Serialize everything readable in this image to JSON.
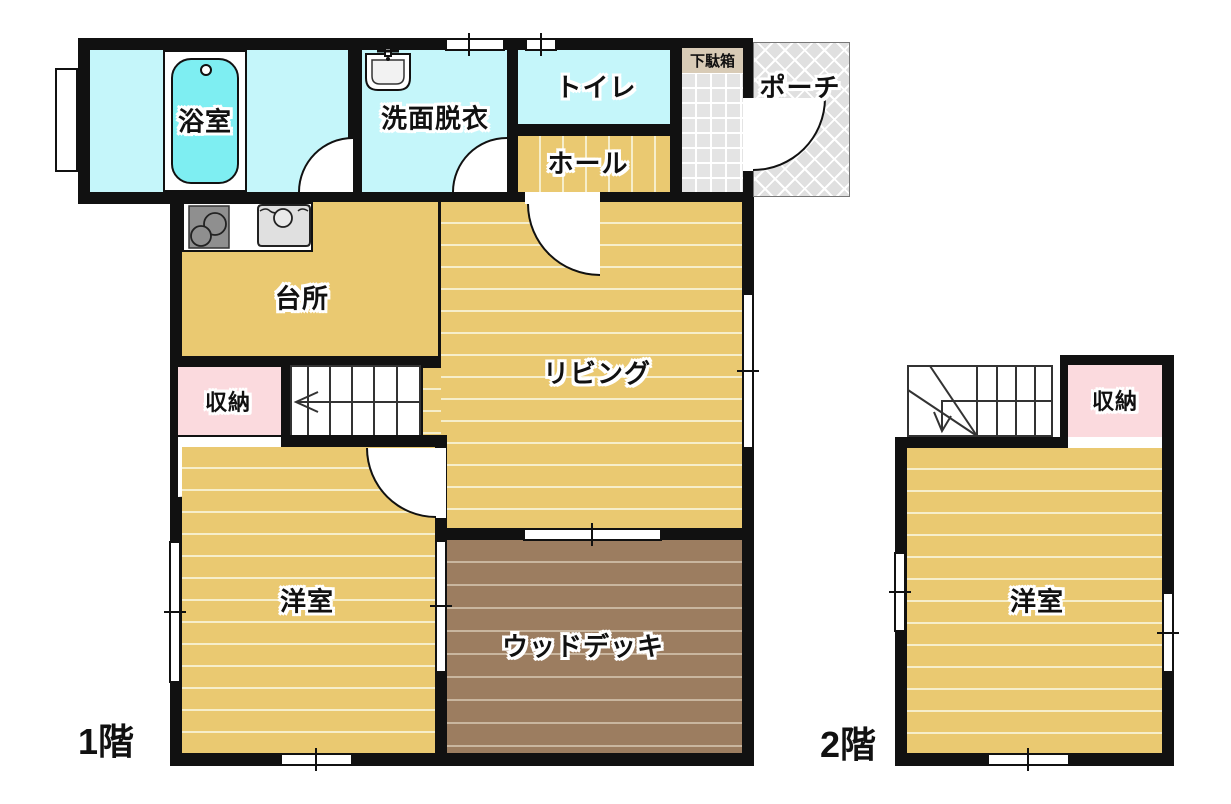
{
  "plan": {
    "floor1": {
      "label": "1階",
      "rooms": {
        "bath": "浴室",
        "washroom": "洗面脱衣",
        "toilet": "トイレ",
        "hall": "ホール",
        "shoe_cabinet": "下駄箱",
        "porch": "ポーチ",
        "kitchen": "台所",
        "living": "リビング",
        "storage": "収納",
        "western_room": "洋室",
        "wood_deck": "ウッドデッキ"
      }
    },
    "floor2": {
      "label": "2階",
      "rooms": {
        "storage": "収納",
        "western_room": "洋室"
      }
    },
    "colors": {
      "wall": "#111111",
      "wet_room_cyan": "#c5f6fa",
      "bathtub_cyan": "#7eeef2",
      "wood_floor_tan": "#eac971",
      "floor_line_cream": "#f6eecb",
      "storage_pink": "#fbdade",
      "deck_brown": "#9c7d60",
      "porch_gray": "#e0e0e0",
      "entrance_tile_gray": "#e4e4e4",
      "shoe_cabinet_beige": "#d8cbb6"
    }
  }
}
